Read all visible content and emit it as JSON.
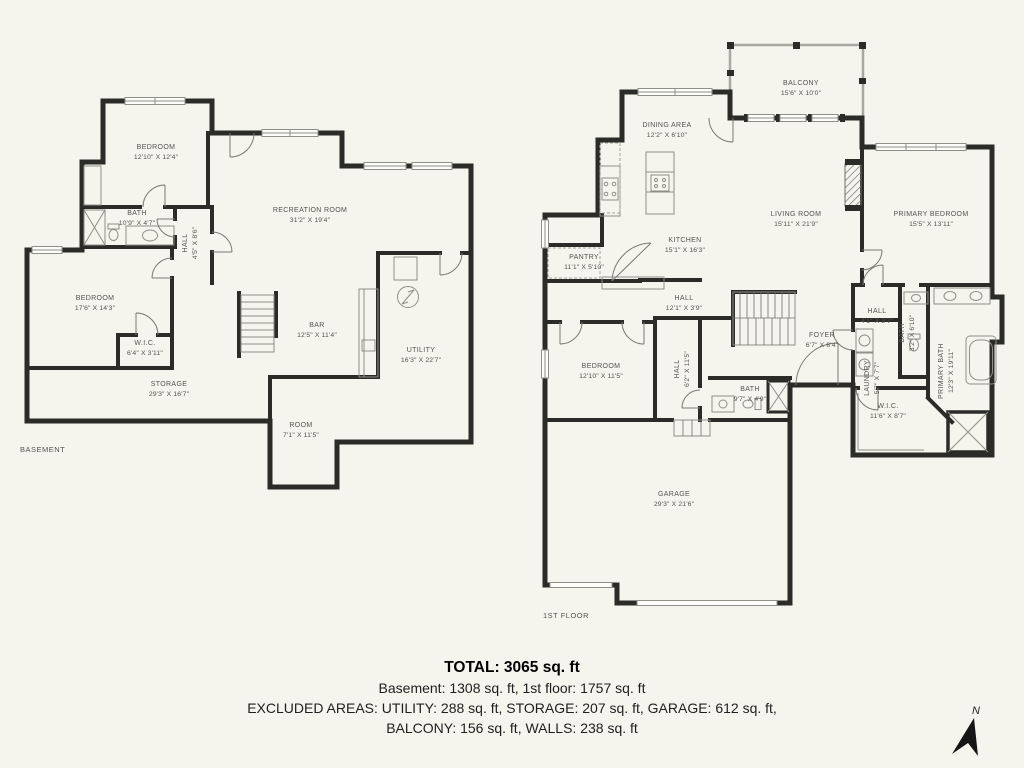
{
  "page": {
    "background_color": "#f5f4ed",
    "wall_color": "#2b2b28",
    "label_color": "#54544e"
  },
  "basement": {
    "floor_label": "BASEMENT",
    "rooms": [
      {
        "name": "BEDROOM",
        "dims": "12'10\" X 12'4\""
      },
      {
        "name": "BATH",
        "dims": "10'9\" X 4'7\""
      },
      {
        "name": "HALL",
        "dims": "4'5\" X 8'6\""
      },
      {
        "name": "RECREATION ROOM",
        "dims": "31'2\" X 19'4\""
      },
      {
        "name": "BEDROOM",
        "dims": "17'6\" X 14'3\""
      },
      {
        "name": "W.I.C.",
        "dims": "6'4\" X 3'11\""
      },
      {
        "name": "STORAGE",
        "dims": "29'3\" X 16'7\""
      },
      {
        "name": "BAR",
        "dims": "12'5\" X 11'4\""
      },
      {
        "name": "UTILITY",
        "dims": "16'3\" X 22'7\""
      },
      {
        "name": "ROOM",
        "dims": "7'1\" X 11'5\""
      }
    ]
  },
  "first_floor": {
    "floor_label": "1ST FLOOR",
    "rooms": [
      {
        "name": "BALCONY",
        "dims": "15'6\" X 10'0\""
      },
      {
        "name": "DINING AREA",
        "dims": "12'2\" X 6'10\""
      },
      {
        "name": "KITCHEN",
        "dims": "15'1\" X 16'3\""
      },
      {
        "name": "LIVING ROOM",
        "dims": "15'11\" X 21'9\""
      },
      {
        "name": "PRIMARY BEDROOM",
        "dims": "15'5\" X 13'11\""
      },
      {
        "name": "PANTRY",
        "dims": "11'1\" X 5'10\""
      },
      {
        "name": "HALL",
        "dims": "12'1\" X 3'9\""
      },
      {
        "name": "BEDROOM",
        "dims": "12'10\" X 11'5\""
      },
      {
        "name": "HALL",
        "dims": "6'2\" X 11'5\""
      },
      {
        "name": "FOYER",
        "dims": "6'7\" X 8'4\""
      },
      {
        "name": "BATH",
        "dims": "9'7\" X 4'9\""
      },
      {
        "name": "HALL",
        "dims": "4'1\" X 3'7\""
      },
      {
        "name": "BATH",
        "dims": "3'2\" X 6'10\""
      },
      {
        "name": "LAUNDRY",
        "dims": "5'7\" X 7'7\""
      },
      {
        "name": "PRIMARY BATH",
        "dims": "12'3\" X 19'11\""
      },
      {
        "name": "W.I.C.",
        "dims": "11'6\" X 8'7\""
      },
      {
        "name": "GARAGE",
        "dims": "29'3\" X 21'6\""
      }
    ]
  },
  "summary": {
    "total": "TOTAL: 3065 sq. ft",
    "line2": "Basement: 1308 sq. ft, 1st floor: 1757 sq. ft",
    "line3": "EXCLUDED AREAS: UTILITY: 288 sq. ft, STORAGE: 207 sq. ft, GARAGE: 612 sq. ft,",
    "line4": "BALCONY: 156 sq. ft, WALLS: 238 sq. ft"
  },
  "compass": {
    "north_label": "N"
  }
}
